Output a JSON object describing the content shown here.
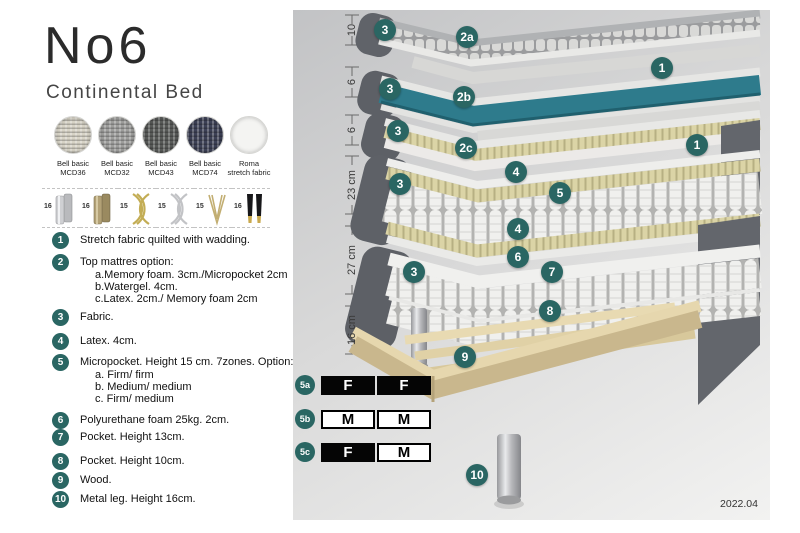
{
  "header": {
    "title": "No6",
    "subtitle": "Continental Bed"
  },
  "fabrics": [
    {
      "line1": "Bell basic",
      "line2": "MCD36",
      "color": "#d7d3c6"
    },
    {
      "line1": "Bell basic",
      "line2": "MCD32",
      "color": "#9e9e9c"
    },
    {
      "line1": "Bell basic",
      "line2": "MCD43",
      "color": "#585a58"
    },
    {
      "line1": "Bell basic",
      "line2": "MCD74",
      "color": "#3d4156"
    },
    {
      "line1": "Roma",
      "line2": "stretch fabric",
      "color": "#f4f4f2"
    }
  ],
  "leg_options": [
    {
      "height": "16",
      "type": "cylinder-silver"
    },
    {
      "height": "16",
      "type": "cylinder-brass"
    },
    {
      "height": "15",
      "type": "cross-gold"
    },
    {
      "height": "15",
      "type": "cross-silver"
    },
    {
      "height": "15",
      "type": "hairpin-gold"
    },
    {
      "height": "16",
      "type": "taper-black-gold"
    }
  ],
  "legend": [
    {
      "num": "1",
      "text": "Stretch fabric quilted with wadding.",
      "sub": []
    },
    {
      "num": "2",
      "text": "Top mattres option:",
      "sub": [
        "a.Memory foam. 3cm./Micropocket 2cm",
        "b.Watergel. 4cm.",
        "c.Latex. 2cm./ Memory foam 2cm"
      ]
    },
    {
      "num": "3",
      "text": "Fabric.",
      "sub": []
    },
    {
      "num": "4",
      "text": "Latex. 4cm.",
      "sub": []
    },
    {
      "num": "5",
      "text": "Micropocket. Height 15 cm. 7zones. Option:",
      "sub": [
        "a. Firm/ firm",
        "b. Medium/ medium",
        "c. Firm/ medium"
      ]
    },
    {
      "num": "6",
      "text": "Polyurethane foam 25kg. 2cm.",
      "sub": []
    },
    {
      "num": "7",
      "text": "Pocket. Height 13cm.",
      "sub": []
    },
    {
      "num": "8",
      "text": "Pocket. Height 10cm.",
      "sub": []
    },
    {
      "num": "9",
      "text": "Wood.",
      "sub": []
    },
    {
      "num": "10",
      "text": "Metal leg. Height 16cm.",
      "sub": []
    }
  ],
  "diagram": {
    "measurements": [
      "10",
      "6",
      "6",
      "23 cm",
      "27 cm",
      "16 cm"
    ],
    "badges": [
      "3",
      "2a",
      "1",
      "3",
      "2b",
      "3",
      "2c",
      "1",
      "4",
      "3",
      "5",
      "4",
      "6",
      "3",
      "7",
      "8",
      "9",
      "10"
    ],
    "firmness": [
      {
        "label": "5a",
        "cells": [
          {
            "text": "F"
          },
          {
            "text": "F"
          }
        ]
      },
      {
        "label": "5b",
        "cells": [
          {
            "text": "M"
          },
          {
            "text": "M"
          }
        ]
      },
      {
        "label": "5c",
        "cells": [
          {
            "text": "F"
          },
          {
            "text": "M"
          }
        ]
      }
    ],
    "version": "2022.04"
  },
  "colors": {
    "badge_teal": "#2a6663",
    "watergel_teal": "#2e7b8c",
    "latex_yellow": "#d9d2a2",
    "fabric_gray": "#5e6167",
    "wood": "#ddcba0"
  }
}
